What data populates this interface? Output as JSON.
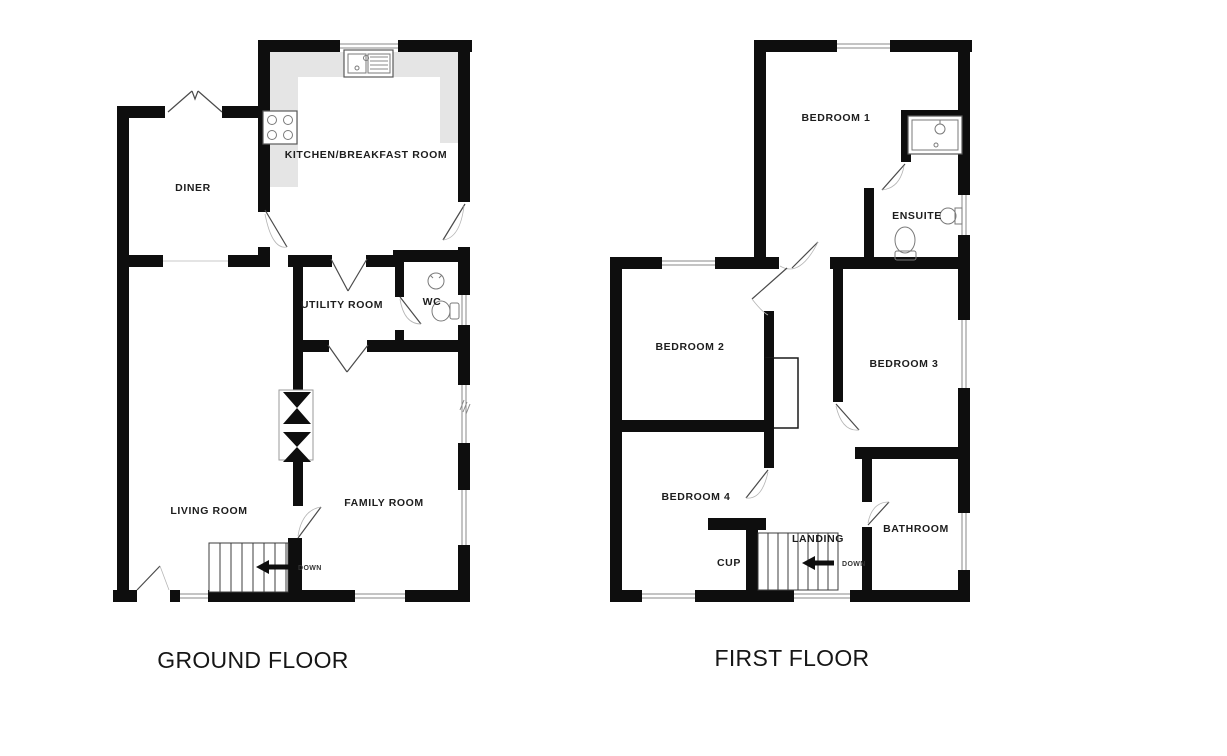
{
  "ground_floor": {
    "title": "GROUND FLOOR",
    "rooms": {
      "kitchen": "KITCHEN/BREAKFAST ROOM",
      "diner": "DINER",
      "utility": "UTILITY ROOM",
      "wc": "WC",
      "living": "LIVING ROOM",
      "family": "FAMILY ROOM"
    },
    "stairs": {
      "down_label": "DOWN"
    }
  },
  "first_floor": {
    "title": "FIRST FLOOR",
    "rooms": {
      "bedroom1": "BEDROOM 1",
      "ensuite": "ENSUITE",
      "bedroom2": "BEDROOM 2",
      "bedroom3": "BEDROOM 3",
      "bedroom4": "BEDROOM 4",
      "bathroom": "BATHROOM",
      "landing": "LANDING",
      "cupboard": "CUP"
    },
    "stairs": {
      "down_label": "DOWN"
    }
  },
  "colors": {
    "wall": "#0e0e0e",
    "counter": "#e5e5e5",
    "label": "#1d1d1d"
  }
}
